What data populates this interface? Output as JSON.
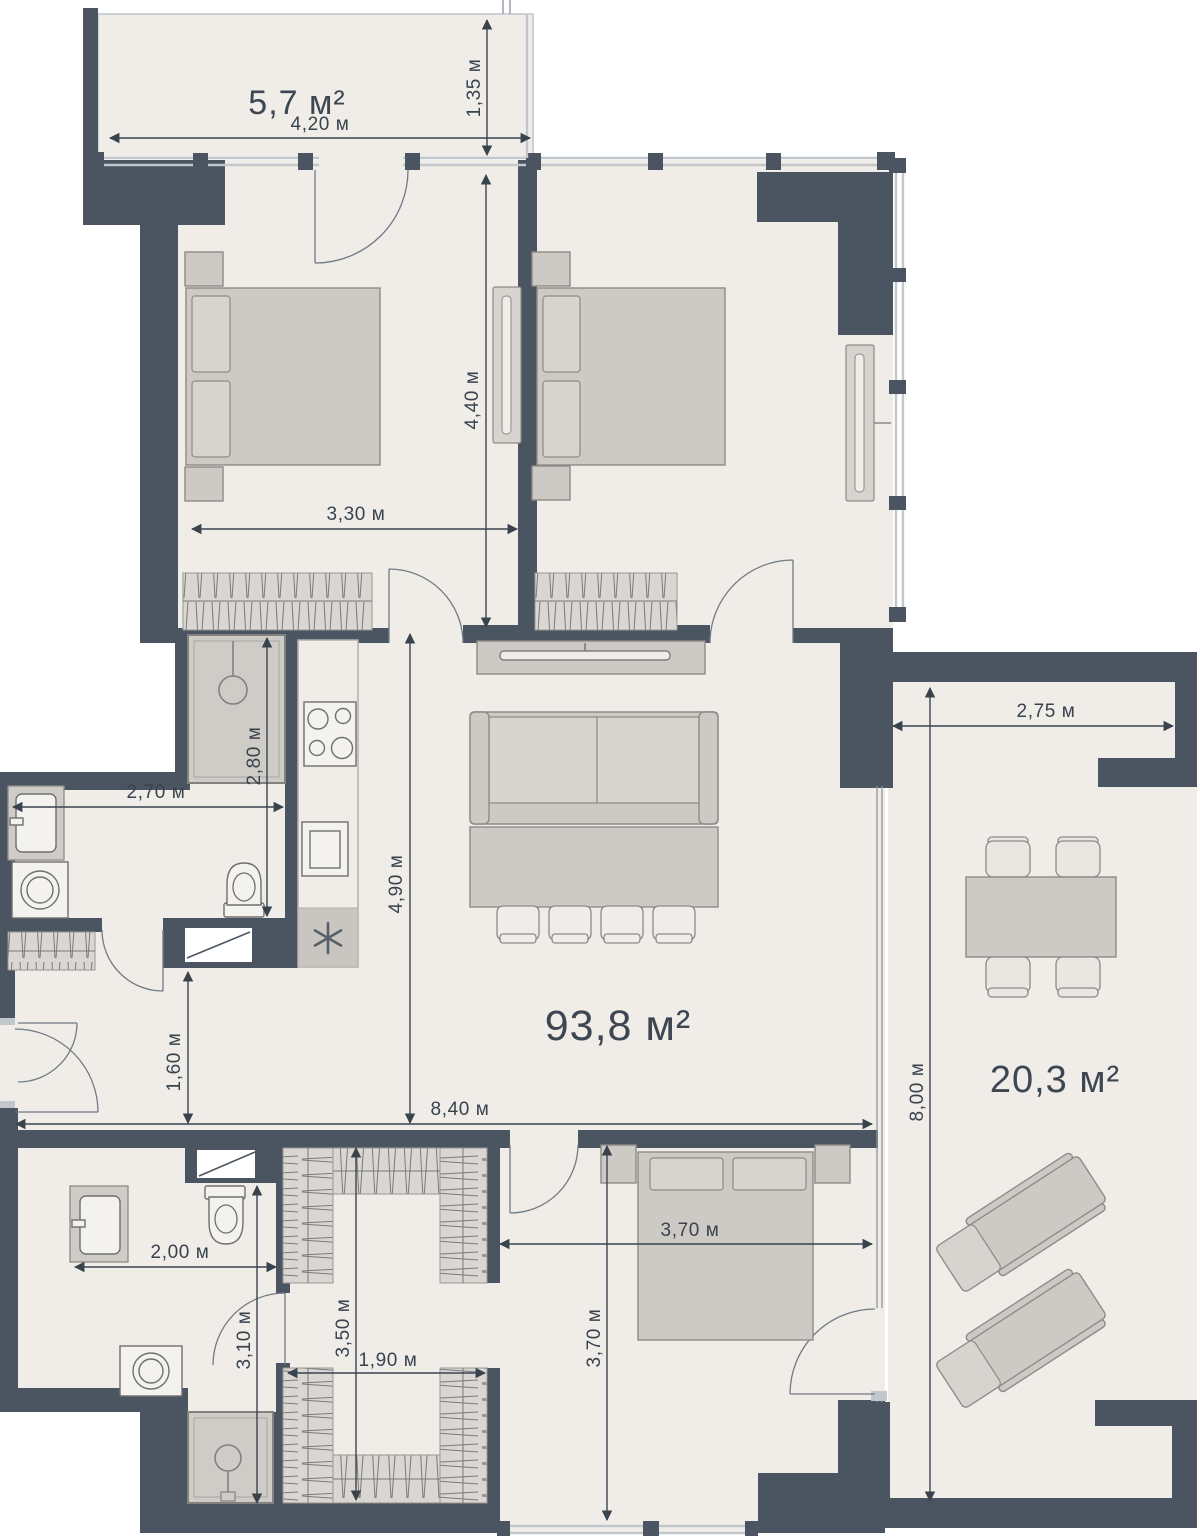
{
  "plan": {
    "type": "apartment-floor-plan",
    "areas": {
      "balcony": "5,7 м²",
      "living": "93,8 м²",
      "terrace": "20,3 м²"
    },
    "dims": {
      "w420": "4,20 м",
      "h135": "1,35 м",
      "h440": "4,40 м",
      "w330": "3,30 м",
      "h280": "2,80 м",
      "w270": "2,70 м",
      "h490": "4,90 м",
      "h160": "1,60 м",
      "w840": "8,40 м",
      "w275": "2,75 м",
      "h800": "8,00 м",
      "w200": "2,00 м",
      "h310": "3,10 м",
      "h350": "3,50 м",
      "w190": "1,90 м",
      "w370": "3,70 м",
      "h370": "3,70 м"
    },
    "icons": {
      "snowflake": "✳",
      "shower": "shower-head",
      "toilet": "toilet-bowl",
      "sink": "wash-basin",
      "washer": "washing-machine",
      "stove": "4-burner-stove"
    },
    "colors": {
      "wall": "#4a5561",
      "floor": "#f0ede9",
      "furniture": "#cdc9c4",
      "window": "#c2c7cc",
      "dimension": "#39434e"
    }
  }
}
